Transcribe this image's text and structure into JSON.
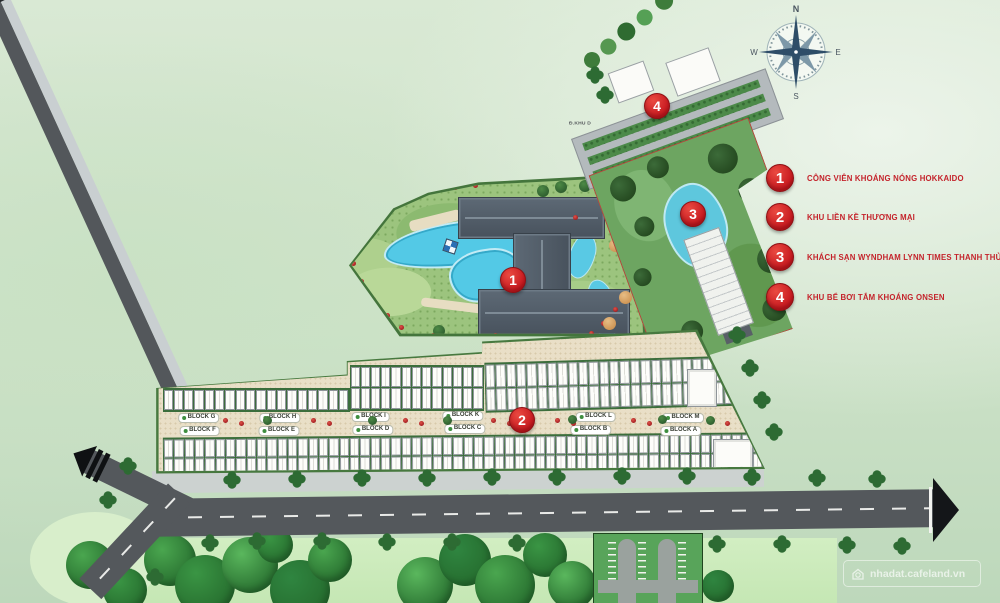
{
  "compass": {
    "n": "N",
    "e": "E",
    "s": "S",
    "w": "W"
  },
  "legend": {
    "items": [
      {
        "number": "1",
        "label": "CÔNG VIÊN KHOÁNG NÓNG HOKKAIDO"
      },
      {
        "number": "2",
        "label": "KHU LIỀN KỀ THƯƠNG MẠI"
      },
      {
        "number": "3",
        "label": "KHÁCH SẠN WYNDHAM LYNN TIMES THANH THỦY"
      },
      {
        "number": "4",
        "label": "KHU BỂ BƠI TẮM KHOÁNG ONSEN"
      }
    ]
  },
  "map_markers": [
    {
      "number": "1"
    },
    {
      "number": "2"
    },
    {
      "number": "3"
    },
    {
      "number": "4"
    }
  ],
  "blocks": {
    "top": [
      "BLOCK G",
      "BLOCK H",
      "BLOCK I",
      "BLOCK K",
      "BLOCK L",
      "BLOCK M"
    ],
    "bottom": [
      "BLOCK F",
      "BLOCK E",
      "BLOCK D",
      "BLOCK C",
      "BLOCK B",
      "BLOCK A"
    ]
  },
  "road_label": "Đ.KHU D",
  "watermark": "nhadat.cafeland.vn",
  "colors": {
    "marker_red": "#c4161d",
    "legend_text": "#c4232b",
    "road_gray": "#54585c",
    "water_blue": "#53c9e6",
    "ground_beige": "#e9dfc7"
  }
}
